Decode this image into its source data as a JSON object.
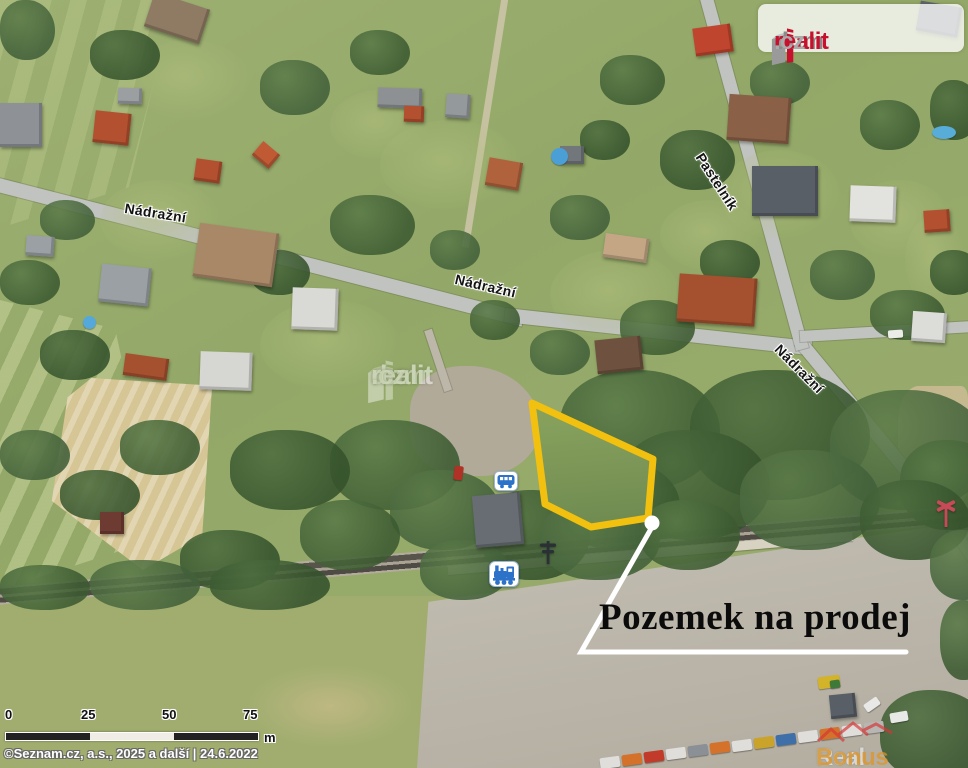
{
  "branding": {
    "logo": {
      "dum": "dum",
      "realit": "realit",
      "tld": ".cz"
    },
    "center_watermark": {
      "dum": "dum",
      "realit": "realit",
      "tld": ".cz"
    },
    "corner_watermark": {
      "real": "Real",
      "bonus": "Bonus"
    }
  },
  "map": {
    "street_labels": [
      "Nádražní",
      "Nádražní",
      "Pastelník",
      "Nádražní"
    ],
    "annotation": "Pozemek na prodej",
    "plot_outline_color": "#f2c00e",
    "icons": {
      "bus_stop": "bus-icon",
      "railway_station": "train-icon",
      "railway_crossing_sign": "crossing-signpost-icon",
      "railway_crossing": "crossing-cross-icon"
    }
  },
  "scalebar": {
    "ticks": [
      "0",
      "25",
      "50",
      "75"
    ],
    "unit": "m"
  },
  "attribution": "©Seznam.cz, a.s., 2025 a další | 24.6.2022",
  "colors": {
    "logo_red": "#c8102e",
    "logo_gray": "#8a8a8a",
    "bonus_orange": "#e09420",
    "callout_white": "#ffffff"
  }
}
